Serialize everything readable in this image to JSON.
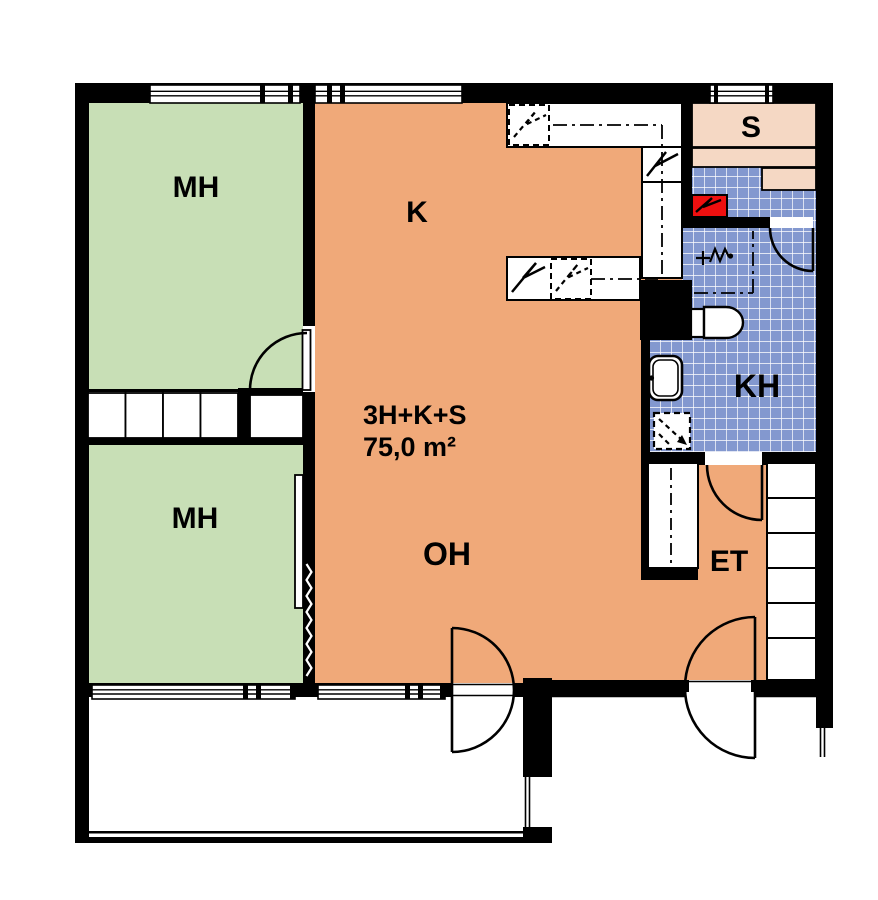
{
  "plan": {
    "type_label": "3H+K+S",
    "area_label": "75,0 m²"
  },
  "rooms": {
    "mh1": {
      "label": "MH"
    },
    "mh2": {
      "label": "MH"
    },
    "k": {
      "label": "K"
    },
    "oh": {
      "label": "OH"
    },
    "kh": {
      "label": "KH"
    },
    "s": {
      "label": "S"
    },
    "et": {
      "label": "ET"
    }
  },
  "colors": {
    "bedroom_green": "#c8dfb6",
    "living_orange": "#f0a979",
    "tile_blue": "#8398cf",
    "sauna_pink": "#f5d8c4",
    "stove_red": "#ee0f0f",
    "wall_black": "#000000"
  }
}
